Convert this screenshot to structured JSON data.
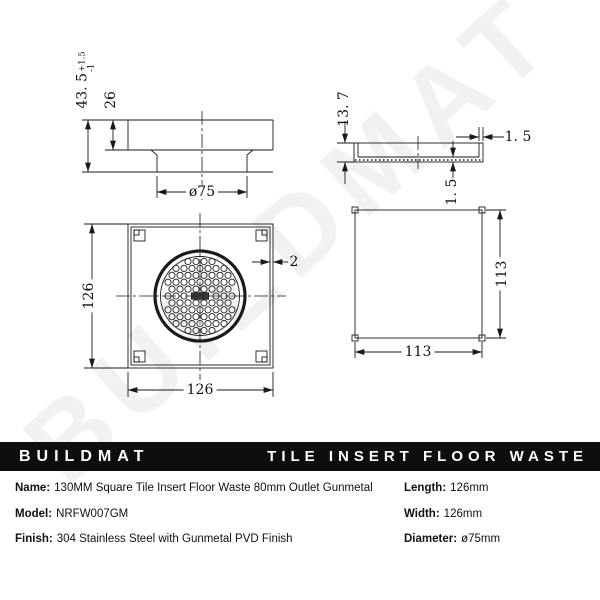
{
  "watermark": "BUILDMAT",
  "colors": {
    "banner_bg": "#0e0e0e",
    "banner_text": "#ffffff",
    "line_color": "#1a1a1a"
  },
  "banner": {
    "brand": "BUILDMAT",
    "product": "TILE INSERT FLOOR WASTE"
  },
  "drawings": {
    "side_view": {
      "overall_height": "43. 5",
      "tol_plus": "+1.5",
      "tol_minus": "-1",
      "flange_height": "26",
      "outlet_diameter": "ø75"
    },
    "tray_side_view": {
      "height": "13. 7",
      "wall_thickness": "1. 5",
      "base_thickness": "1. 5"
    },
    "top_view": {
      "width": "126",
      "height": "126",
      "wall_thickness": "2"
    },
    "bottom_view": {
      "width": "113",
      "height": "113"
    }
  },
  "details": {
    "left": [
      {
        "label": "Name:",
        "value": "130MM Square Tile Insert Floor Waste 80mm Outlet Gunmetal"
      },
      {
        "label": "Model:",
        "value": "NRFW007GM"
      },
      {
        "label": "Finish:",
        "value": "304 Stainless Steel with Gunmetal PVD Finish"
      }
    ],
    "right": [
      {
        "label": "Length:",
        "value": "126mm"
      },
      {
        "label": "Width:",
        "value": "126mm"
      },
      {
        "label": "Diameter:",
        "value": "ø75mm"
      }
    ]
  }
}
